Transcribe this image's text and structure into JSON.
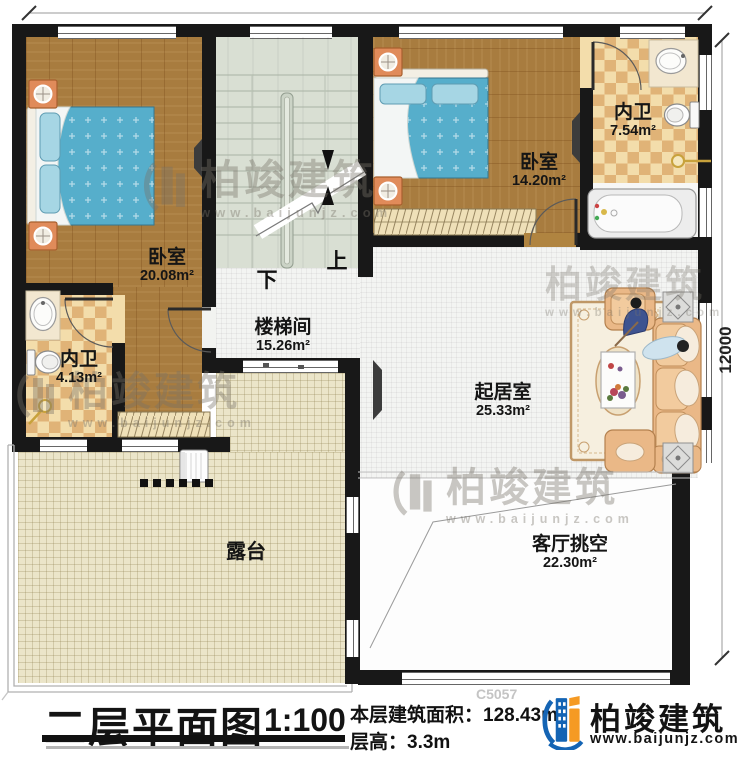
{
  "title_block": {
    "title": "二层平面图",
    "scale": "1:100",
    "area_label": "本层建筑面积：",
    "area_value": "128.43m²",
    "floor_height_label": "层高：",
    "floor_height_value": "3.3m",
    "drawing_code": "C5057"
  },
  "brand": {
    "name": "柏竣建筑",
    "url": "www.baijunjz.com"
  },
  "watermark": {
    "name": "柏竣建筑",
    "url": "www.baijunjz.com"
  },
  "rooms": [
    {
      "id": "bedroom-left",
      "name": "卧室",
      "area": "20.08m²"
    },
    {
      "id": "bath-left",
      "name": "内卫",
      "area": "4.13m²"
    },
    {
      "id": "bedroom-right",
      "name": "卧室",
      "area": "14.20m²"
    },
    {
      "id": "bath-right",
      "name": "内卫",
      "area": "7.54m²"
    },
    {
      "id": "stair-hall",
      "name": "楼梯间",
      "area": "15.26m²"
    },
    {
      "id": "living",
      "name": "起居室",
      "area": "25.33m²"
    },
    {
      "id": "terrace",
      "name": "露台",
      "area": ""
    },
    {
      "id": "void",
      "name": "客厅挑空",
      "area": "22.30m²"
    }
  ],
  "stairs": {
    "up": "上",
    "down": "下"
  },
  "dimensions": {
    "right_total": "12000"
  },
  "colors": {
    "wall": "#181818",
    "wood_floor": "#a87c3f",
    "tile_checker_dark": "#e0b377",
    "tile_checker_light": "#f3ddab",
    "stair_floor": "#d9dfd3",
    "terrace_floor": "#ebe5c9",
    "bed_blue": "#56aecb",
    "sofa_peach": "#eab887",
    "brand_blue": "#1464b4",
    "brand_orange": "#f59a23"
  }
}
